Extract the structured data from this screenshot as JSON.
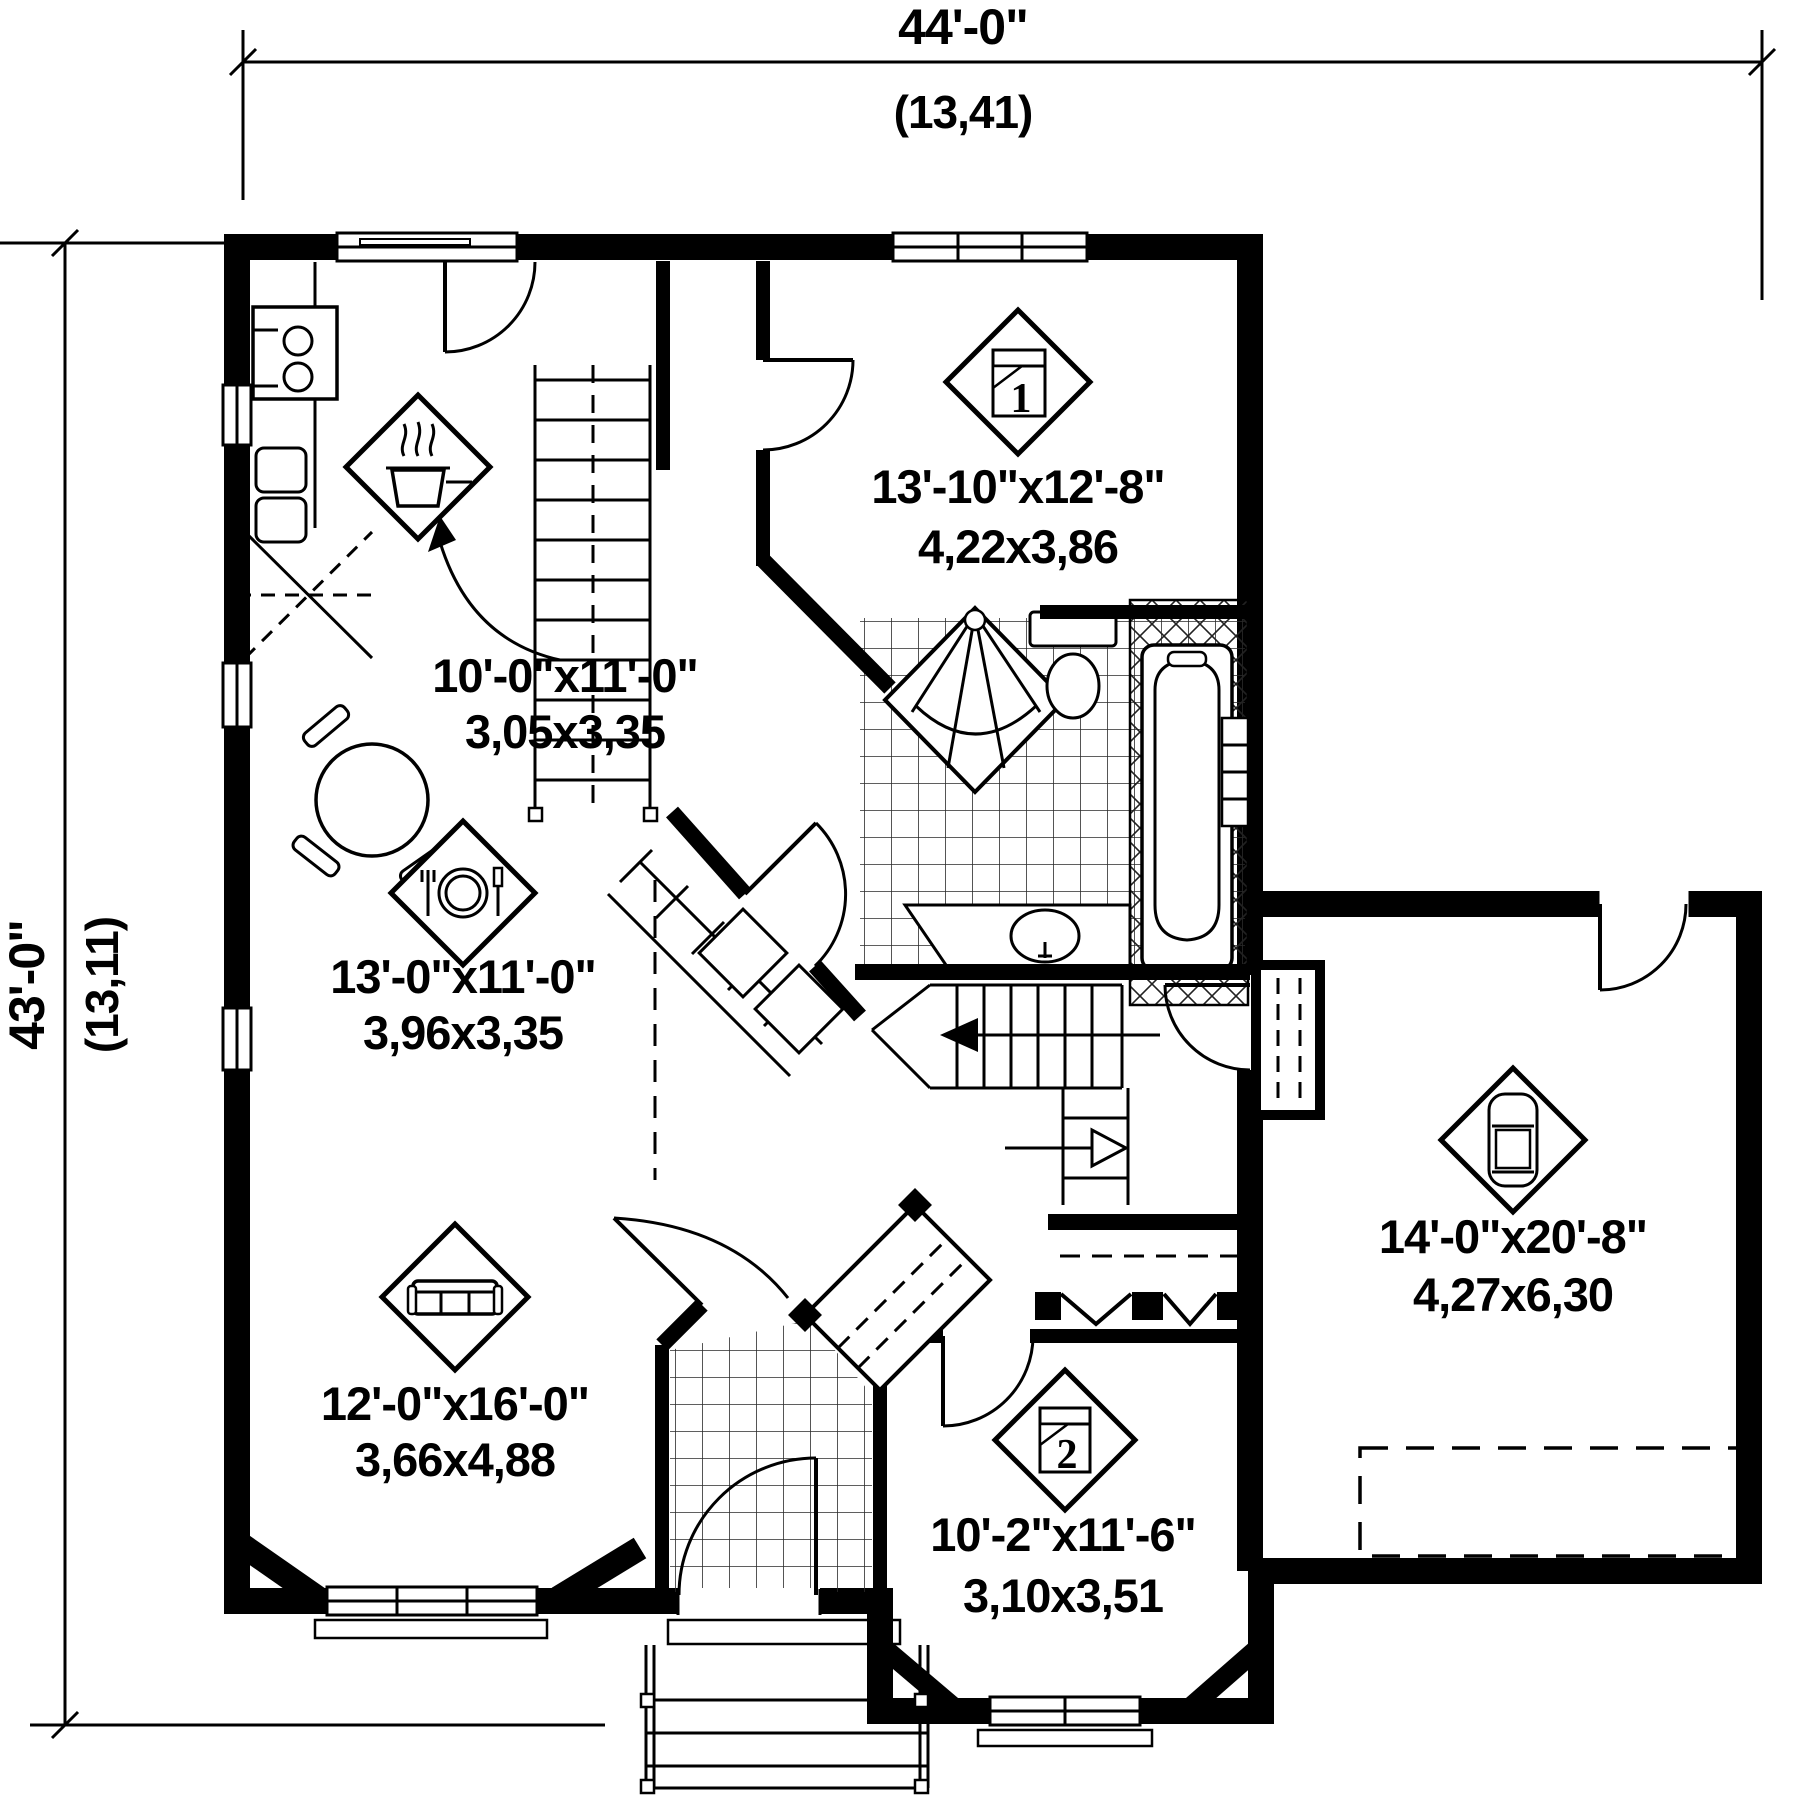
{
  "plan": {
    "title": "house-first-floor-plan",
    "colors": {
      "wall": "#000000",
      "background": "#ffffff",
      "line": "#1a1a1a"
    },
    "overall_dimensions": {
      "width": {
        "imperial": "44'-0\"",
        "metric": "(13,41)"
      },
      "height": {
        "imperial": "43'-0\"",
        "metric": "(13,11)"
      }
    },
    "rooms": [
      {
        "id": "kitchen",
        "icon": "cooking-pot-icon",
        "imperial": "10'-0\"x11'-0\"",
        "metric": "3,05x3,35"
      },
      {
        "id": "dining",
        "icon": "plate-cutlery-icon",
        "imperial": "13'-0\"x11'-0\"",
        "metric": "3,96x3,35"
      },
      {
        "id": "living",
        "icon": "sofa-icon",
        "imperial": "12'-0\"x16'-0\"",
        "metric": "3,66x4,88"
      },
      {
        "id": "bedroom-1",
        "icon": "bed-icon",
        "number": "1",
        "imperial": "13'-10\"x12'-8\"",
        "metric": "4,22x3,86"
      },
      {
        "id": "bedroom-2",
        "icon": "bed-icon",
        "number": "2",
        "imperial": "10'-2\"x11'-6\"",
        "metric": "3,10x3,51"
      },
      {
        "id": "garage",
        "icon": "car-icon",
        "imperial": "14'-0\"x20'-8\"",
        "metric": "4,27x6,30"
      }
    ]
  }
}
